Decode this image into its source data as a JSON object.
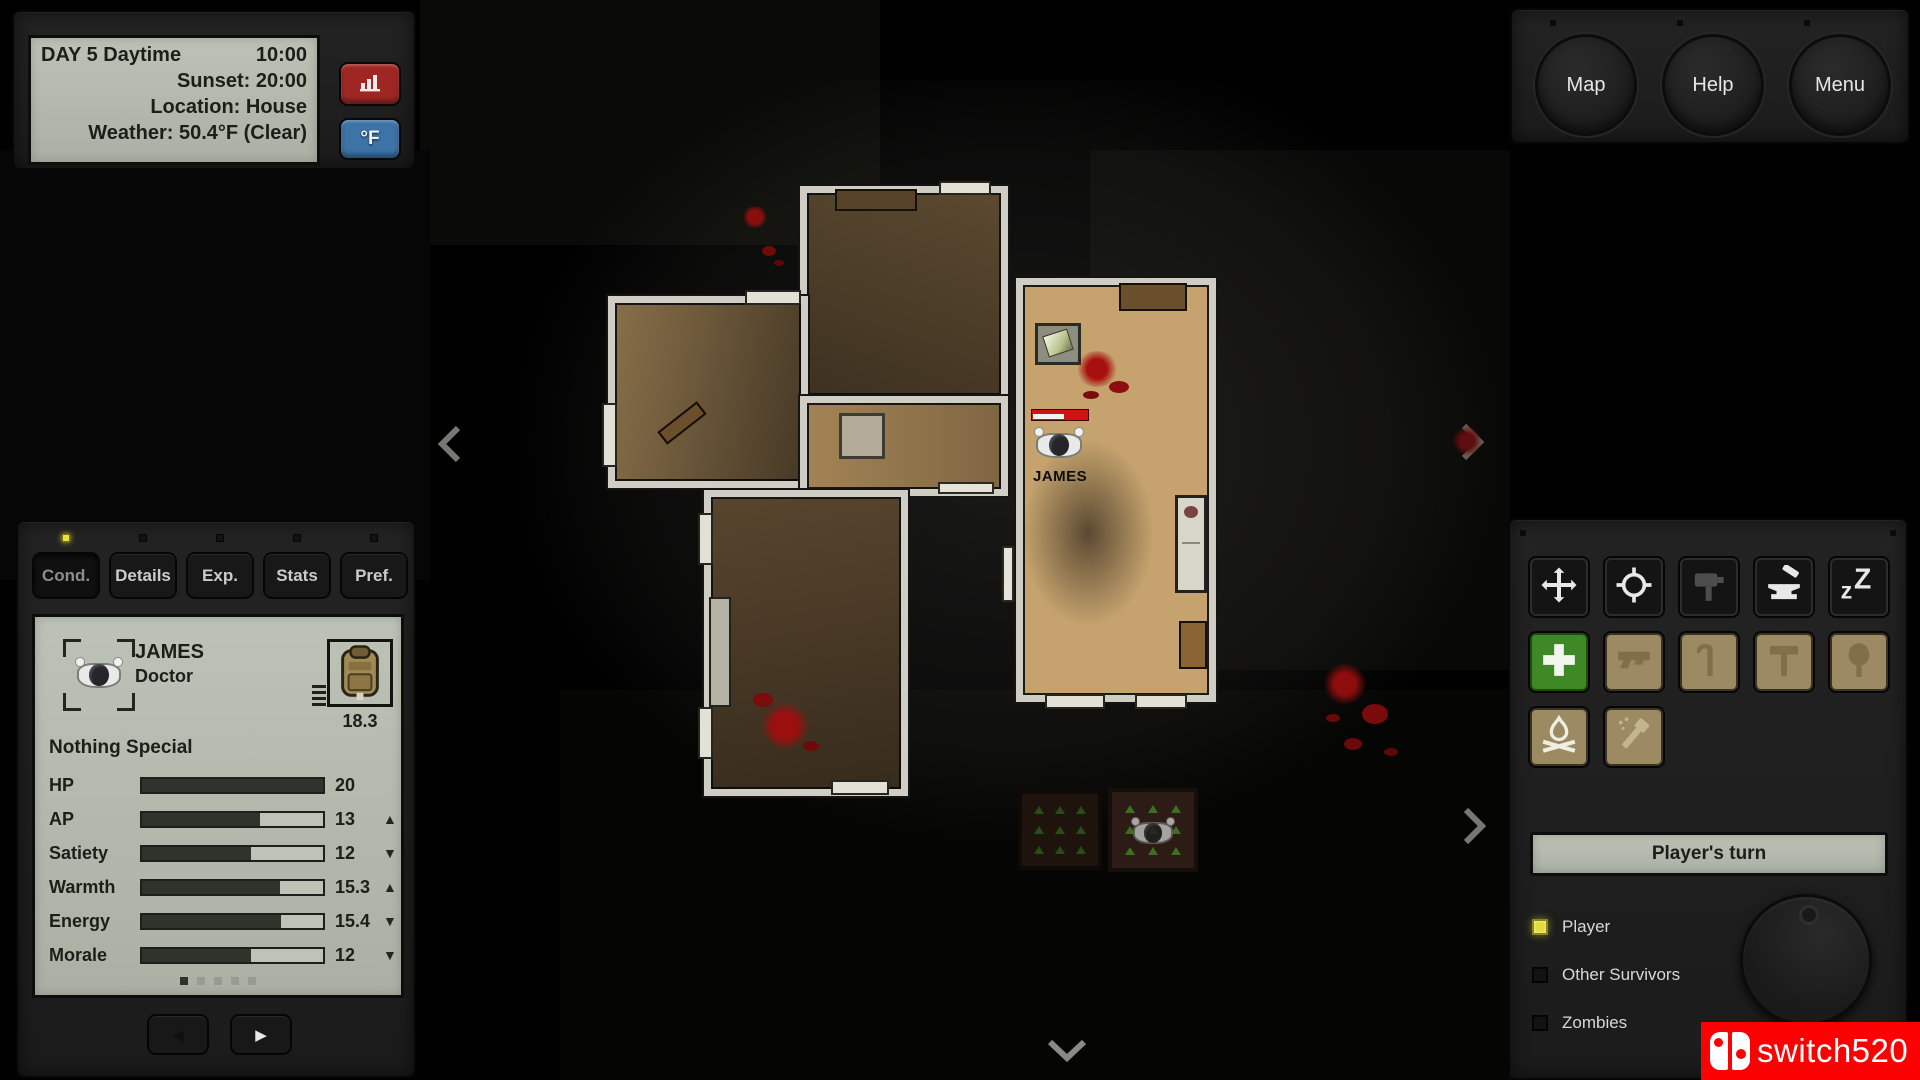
{
  "info_panel": {
    "day": "DAY 5 Daytime",
    "time": "10:00",
    "sunset": "Sunset: 20:00",
    "location": "Location: House",
    "weather": "Weather: 50.4°F (Clear)",
    "chart_button_icon": "bar-chart-icon",
    "temp_button_label": "°F"
  },
  "top_buttons": [
    {
      "label": "Map"
    },
    {
      "label": "Help"
    },
    {
      "label": "Menu"
    }
  ],
  "character_panel": {
    "tabs": [
      {
        "label": "Cond.",
        "selected": true
      },
      {
        "label": "Details",
        "selected": false
      },
      {
        "label": "Exp.",
        "selected": false
      },
      {
        "label": "Stats",
        "selected": false
      },
      {
        "label": "Pref.",
        "selected": false
      }
    ],
    "name": "JAMES",
    "role": "Doctor",
    "carry_weight": "18.3",
    "trait": "Nothing Special",
    "stats": [
      {
        "label": "HP",
        "value": "20",
        "pct": 100,
        "trend": "none"
      },
      {
        "label": "AP",
        "value": "13",
        "pct": 65,
        "trend": "up"
      },
      {
        "label": "Satiety",
        "value": "12",
        "pct": 60,
        "trend": "down"
      },
      {
        "label": "Warmth",
        "value": "15.3",
        "pct": 76.5,
        "trend": "up"
      },
      {
        "label": "Energy",
        "value": "15.4",
        "pct": 77,
        "trend": "down"
      },
      {
        "label": "Morale",
        "value": "12",
        "pct": 60,
        "trend": "down"
      }
    ],
    "page_count": 5,
    "active_page": 0,
    "prev_icon": "◀",
    "next_icon": "▶"
  },
  "action_panel": {
    "icon_rows": [
      [
        {
          "name": "move",
          "style": "dark"
        },
        {
          "name": "target",
          "style": "dark"
        },
        {
          "name": "signpost",
          "style": "dark disabled"
        },
        {
          "name": "craft",
          "style": "dark"
        },
        {
          "name": "sleep",
          "style": "dark"
        }
      ],
      [
        {
          "name": "heal",
          "style": "green"
        },
        {
          "name": "pistol",
          "style": "tan"
        },
        {
          "name": "crowbar",
          "style": "tan"
        },
        {
          "name": "hammer",
          "style": "tan"
        },
        {
          "name": "shovel",
          "style": "tan"
        }
      ],
      [
        {
          "name": "campfire",
          "style": "tan lit"
        },
        {
          "name": "flashlight",
          "style": "tan pale"
        }
      ]
    ],
    "turn_label": "Player's turn",
    "legend": [
      {
        "label": "Player",
        "active": true
      },
      {
        "label": "Other Survivors",
        "active": false
      },
      {
        "label": "Zombies",
        "active": false
      }
    ]
  },
  "map": {
    "player_name": "JAMES"
  },
  "watermark": {
    "text": "switch520"
  },
  "colors": {
    "accent_yellow": "#e8e23a",
    "lcd_green": "#b3b9ad",
    "red_button": "#9e2723",
    "blue_button": "#3d73a6",
    "heal_green": "#3e8926",
    "tan_button": "#9c8a62",
    "blood_red": "#a01010",
    "hp_bar_red": "#d01212",
    "watermark_red": "#fb0102"
  }
}
